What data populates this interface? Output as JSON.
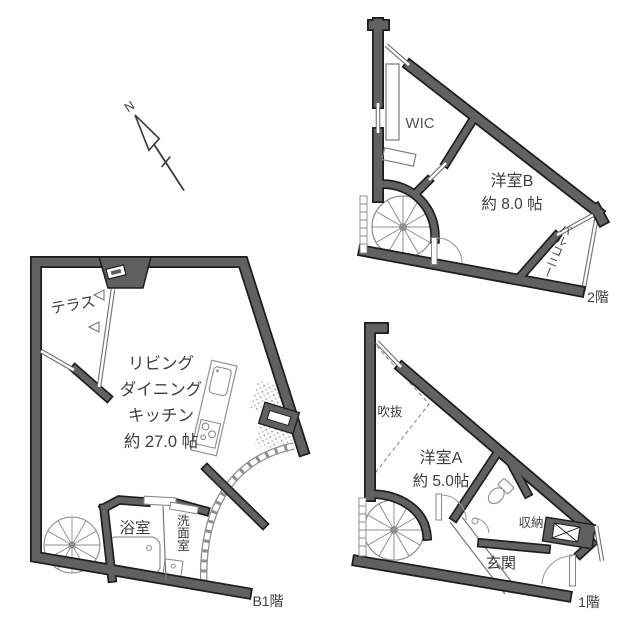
{
  "compass": {
    "north_label": "N"
  },
  "colors": {
    "wall_core": "#616161",
    "wall_edge": "#1d1d1d",
    "background": "#ffffff",
    "text": "#3d3d3d",
    "fixture_stroke": "#979797"
  },
  "floors": {
    "b1": {
      "floor_label": "B1階",
      "rooms": {
        "terrace": "テラス",
        "ldk_line1": "リビング",
        "ldk_line2": "ダイニング",
        "ldk_line3": "キッチン",
        "ldk_size": "約 27.0 帖",
        "bathroom": "浴室",
        "washroom": "洗面室"
      }
    },
    "f2": {
      "floor_label": "2階",
      "rooms": {
        "wic": "WIC",
        "room_b": "洋室B",
        "room_b_size": "約 8.0 帖",
        "balcony": "バルコニー"
      }
    },
    "f1": {
      "floor_label": "1階",
      "rooms": {
        "void": "吹抜",
        "room_a": "洋室A",
        "room_a_size": "約 5.0帖",
        "storage": "収納",
        "entrance": "玄関"
      }
    }
  }
}
